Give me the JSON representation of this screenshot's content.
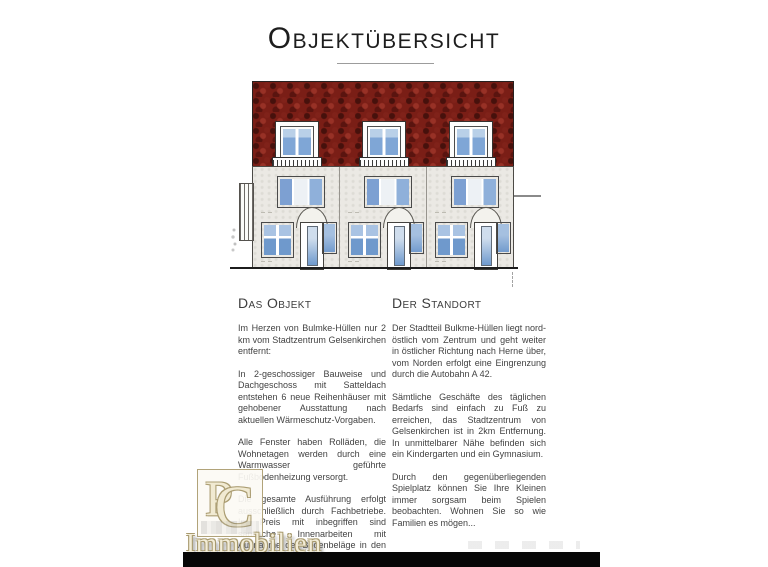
{
  "header": {
    "title": "Objektübersicht"
  },
  "sections": {
    "object": {
      "heading": "Das Objekt",
      "paragraphs": [
        "Im Herzen von Bulmke-Hüllen nur 2 km vom Stadtzentrum Gelsenkirchen entfernt:",
        "In 2-geschossiger Bauweise und Dachgeschoss mit Satteldach entstehen 6 neue Reihenhäuser mit gehobener Ausstattung nach aktuellen Wärmeschutz-Vorgaben.",
        "Alle Fenster haben Rolläden, die Wohnetagen werden durch eine Warmwasser geführte Fußbodenheizung versorgt.",
        "Die gesamte Ausführung erfolgt ausschließlich durch Fachbetriebe. Im Preis mit inbegriffen sind sämtliche Innenarbeiten mit Ausnahme der Bodenbeläge in den Wohnräumen und den Maler- und Lackierarbeiten."
      ]
    },
    "location": {
      "heading": "Der Standort",
      "paragraphs": [
        "Der Stadtteil Bulkme-Hüllen liegt nord-östlich vom Zentrum und geht weiter in östlicher Richtung nach Herne über, vom Norden erfolgt eine Eingrenzung durch die Autobahn A 42.",
        "Sämtliche Geschäfte des täglichen Bedarfs sind einfach zu Fuß zu erreichen, das Stadtzentrum von Gelsenkirchen ist in 2km Entfernung. In unmittelbarer Nähe befinden sich ein Kindergarten und ein Gymnasium.",
        "Durch den gegenüberliegenden Spielplatz können Sie Ihre Kleinen immer sorgsam beim Spielen beobachten. Wohnen Sie so wie Familien es mögen..."
      ]
    }
  },
  "watermark": {
    "monogram_left": "P",
    "monogram_right": "C",
    "label": "Immobilien"
  },
  "colors": {
    "roof_red": "#7a1e16",
    "facade_gray": "#ebe9e4",
    "window_blue": "#7fa6d6",
    "logo_gold": "#ab9d72",
    "footer_bar": "#070707"
  }
}
